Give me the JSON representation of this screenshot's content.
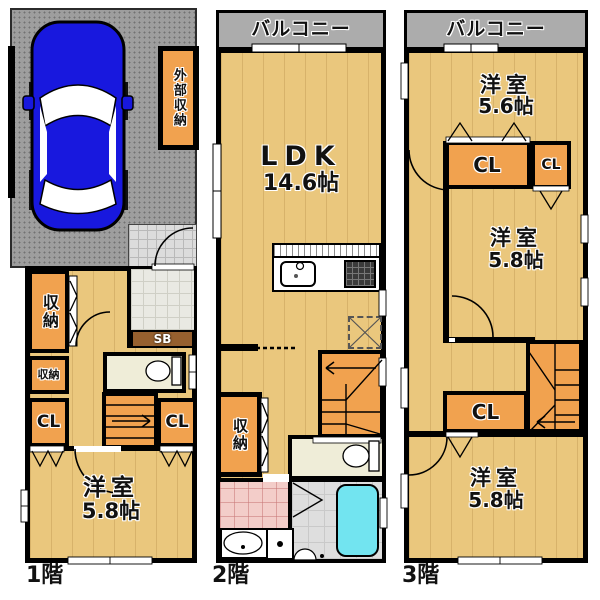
{
  "colors": {
    "wood_floor": "#EAC77D",
    "closet_orange": "#F1A24F",
    "wall_black": "#000000",
    "balcony_gray": "#ACACAC",
    "garage_gray": "#9E9E9E",
    "washroom_pink": "#F3CDC9",
    "toilet_beige": "#EFEDD8",
    "bath_tub_cyan": "#72E4F0",
    "shoe_box_brown": "#96602F",
    "car_blue": "#1818DE"
  },
  "floors": [
    {
      "label": "1階",
      "exterior_storage": "外部収納",
      "storage_tall": "収納",
      "storage_small": "収納",
      "shoe_box": "SB",
      "closet_left": "CL",
      "closet_right": "CL",
      "bedroom": {
        "name": "洋室",
        "size": "5.8帖"
      }
    },
    {
      "label": "2階",
      "balcony": "バルコニー",
      "ldk": {
        "name": "LDK",
        "size": "14.6帖"
      },
      "storage": "収納"
    },
    {
      "label": "3階",
      "balcony": "バルコニー",
      "bedroom_top": {
        "name": "洋室",
        "size": "5.6帖"
      },
      "closet_main": "CL",
      "closet_sub": "CL",
      "bedroom_mid": {
        "name": "洋室",
        "size": "5.8帖"
      },
      "closet_hall": "CL",
      "bedroom_bottom": {
        "name": "洋室",
        "size": "5.8帖"
      }
    }
  ]
}
